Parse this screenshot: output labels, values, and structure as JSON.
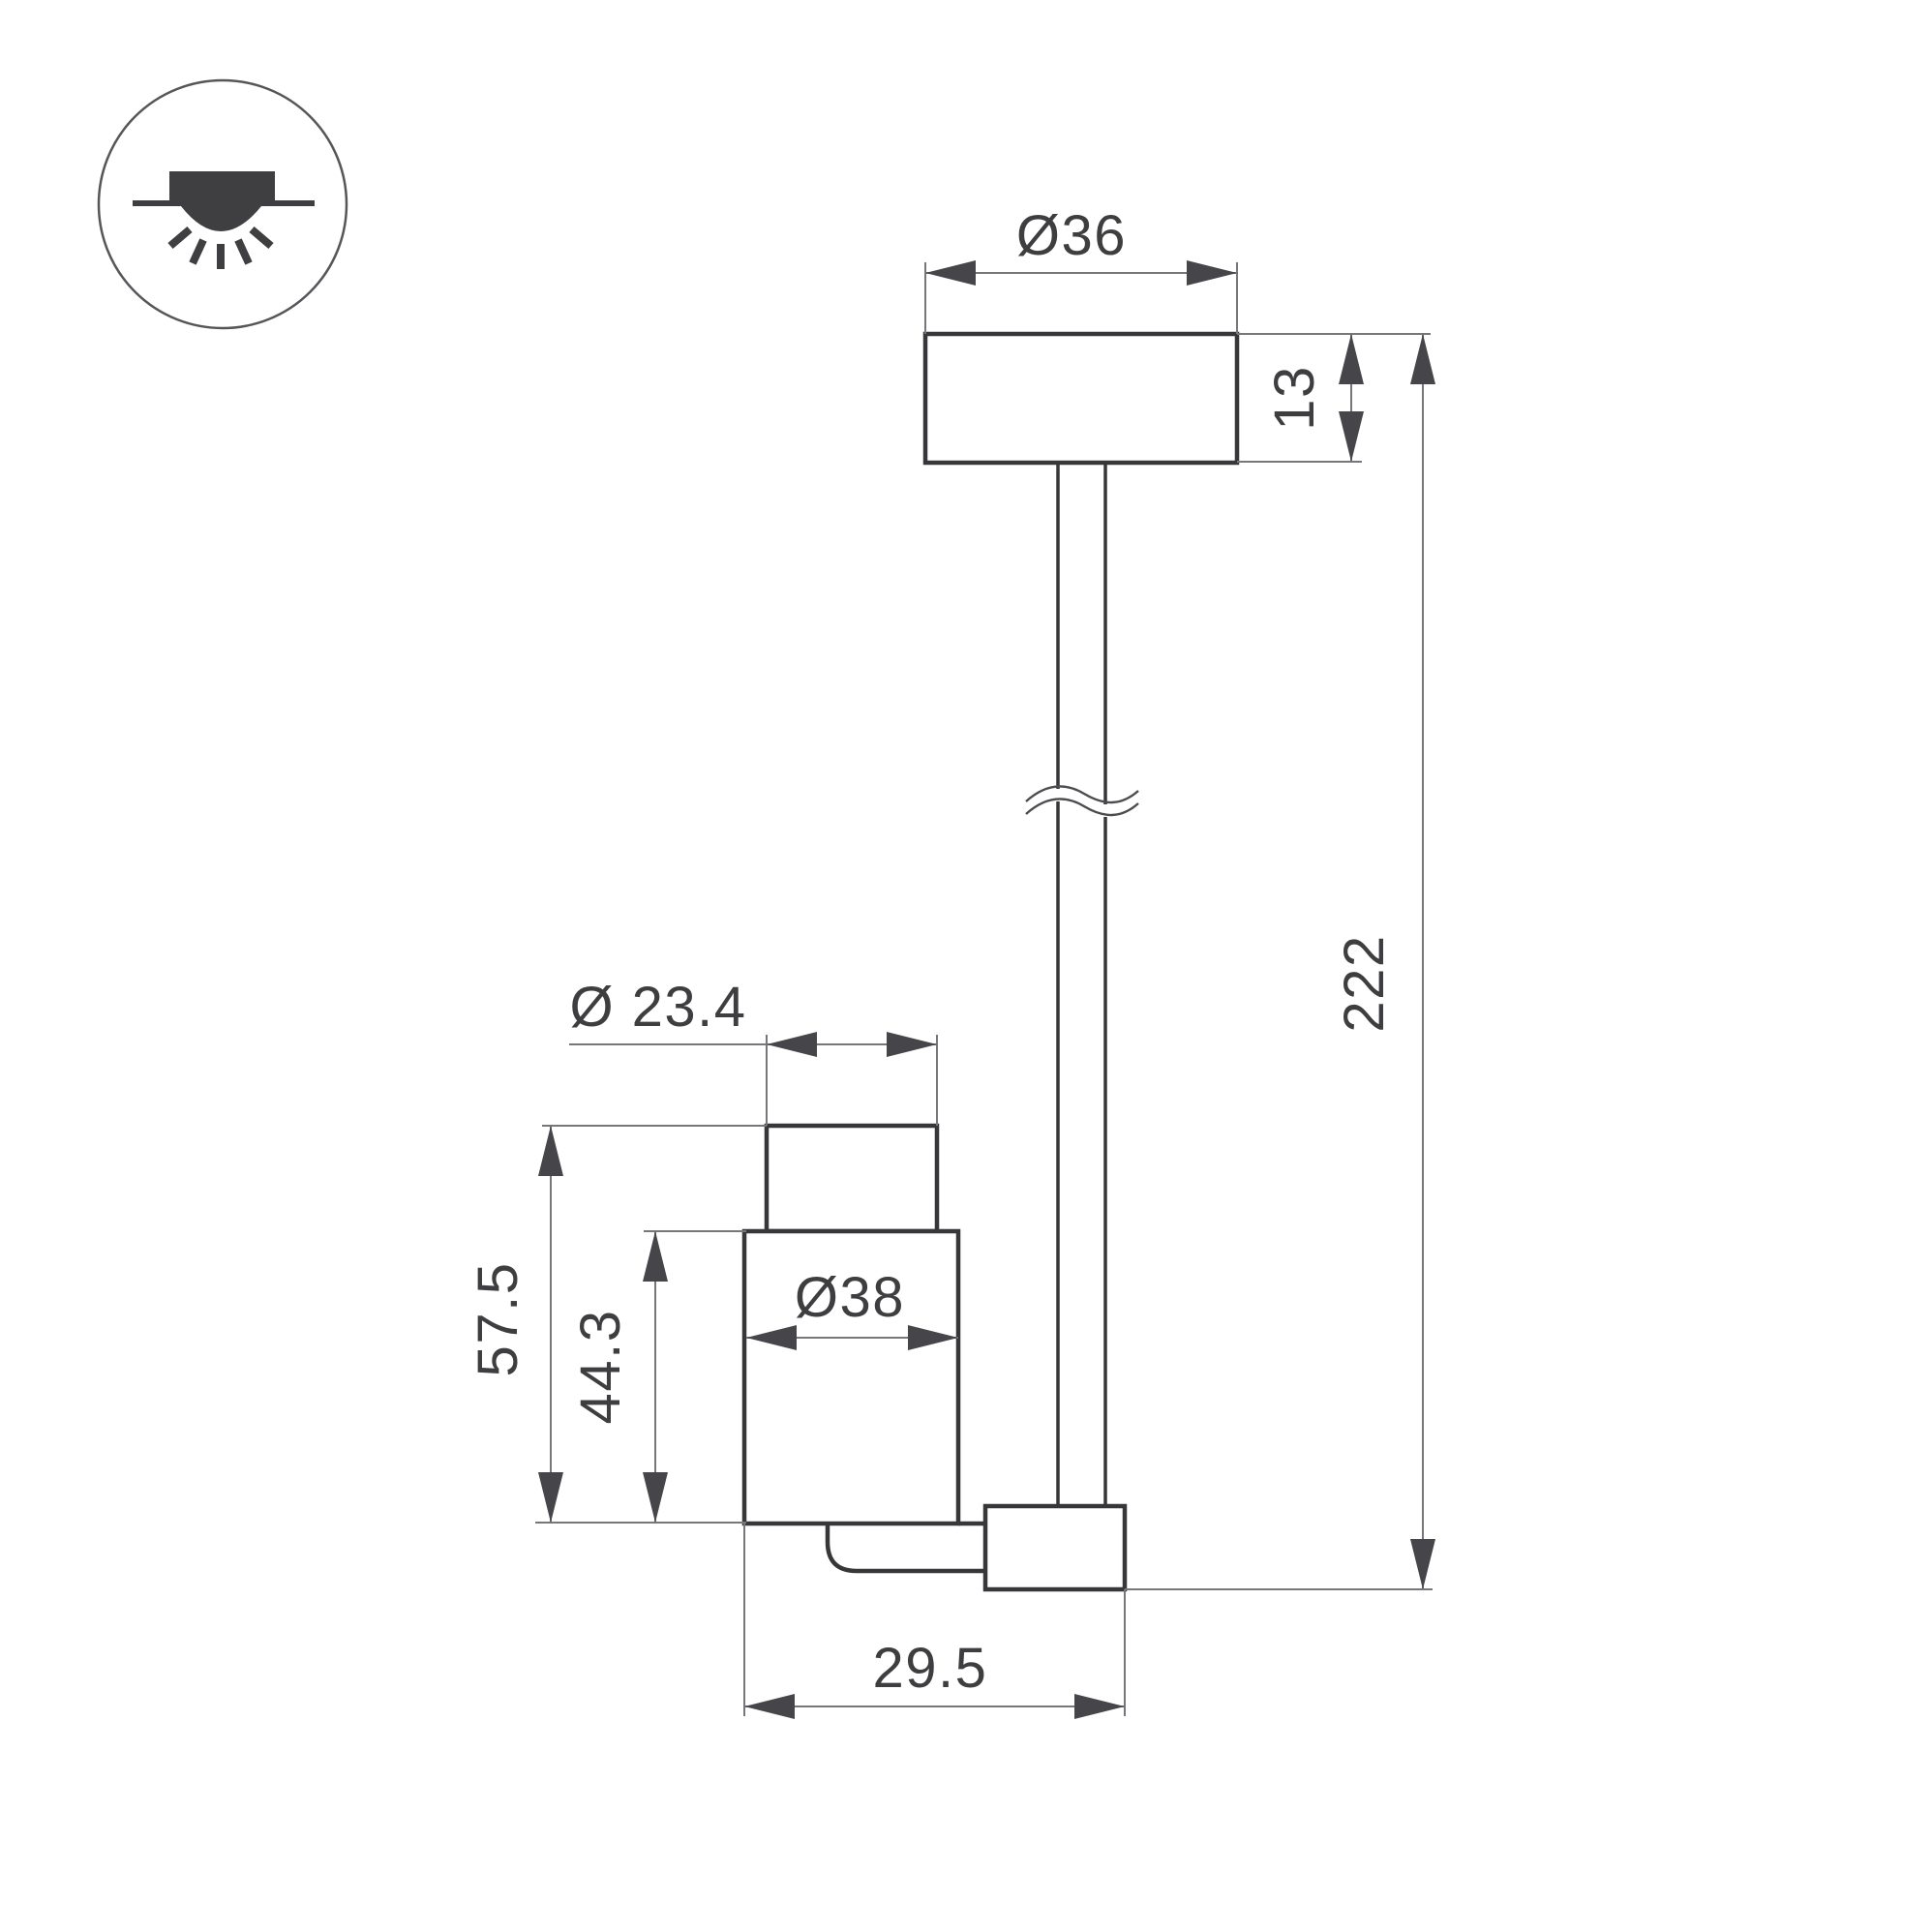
{
  "drawing": {
    "title": "surface-mounted-spot-luminaire-dimension-drawing",
    "colors": {
      "background": "#ffffff",
      "object_line": "#37373a",
      "dimension_line": "#77777b",
      "text": "#3e3e41"
    },
    "dims": {
      "canopy_diameter": "Ø36",
      "canopy_height": "13",
      "overall_length": "222",
      "head_front_diameter": "Ø 23.4",
      "head_body_diameter": "Ø38",
      "head_total_height": "57.5",
      "head_body_height": "44.3",
      "head_depth": "29.5"
    },
    "badge": {
      "icon": "surface-ceiling-downlight-icon"
    }
  }
}
